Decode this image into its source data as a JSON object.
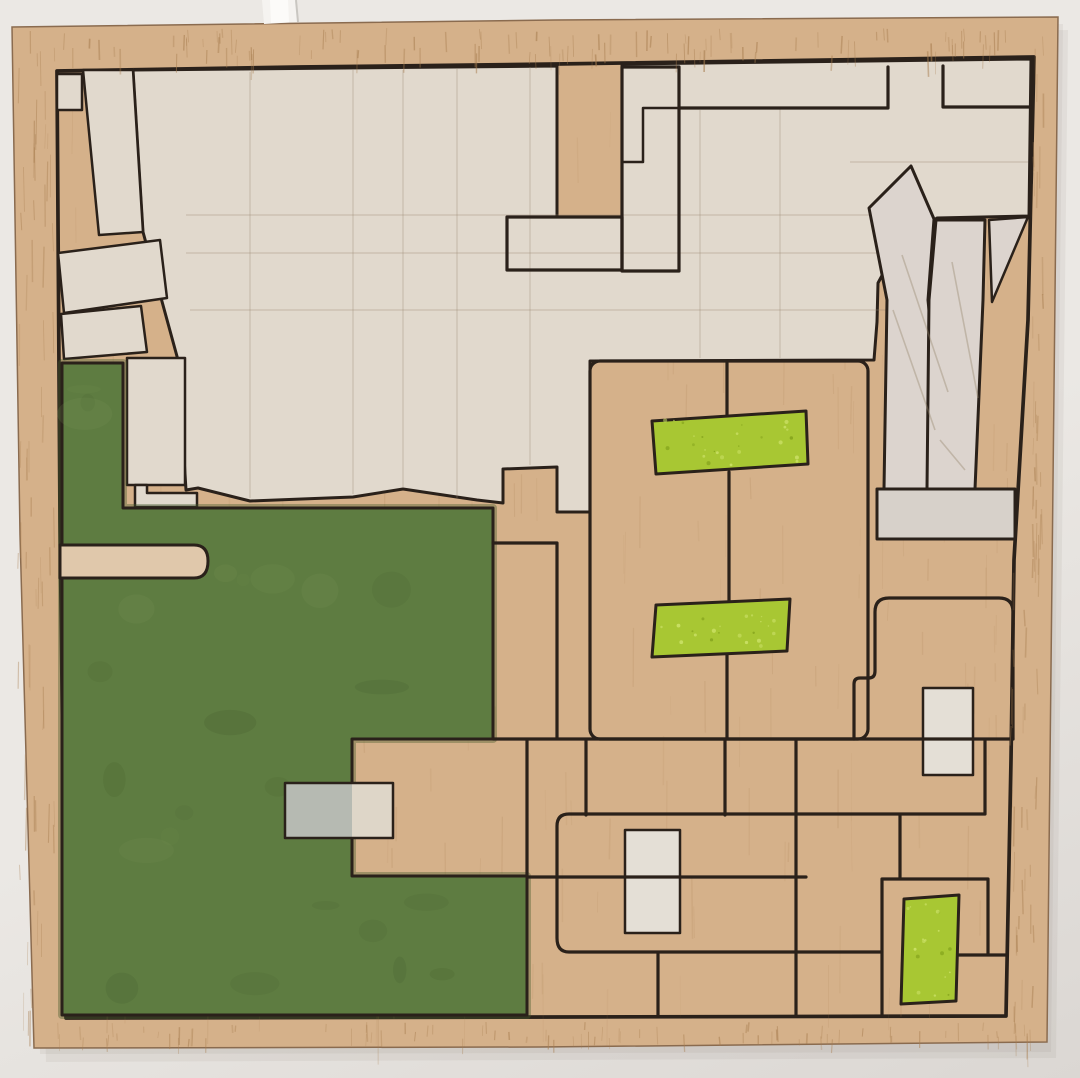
{
  "scene": {
    "type": "photograph of artwork on wall",
    "description": "Square plywood panel hanging on a pale wall; hand-drawn black ink outlines divide the board into irregular rectangular cells; large field painted olive green at lower left, three bright lime-green rectangles, two small whitish blocks, one small grey block, and large cream-painted zones across the top; a white cable hangs at top centre-left.",
    "support": "plywood board with visible wood grain frame margin",
    "hanging_cable": "white cable at top centre-left"
  },
  "elements": {
    "green_field": 1,
    "lime_rectangles": 3,
    "white_blocks": 2,
    "grey_block": 1,
    "cream_zones": 2,
    "x_figure": 1,
    "ink_cells": "irregular hand-drawn rectangular grid"
  },
  "colors": {
    "wall": "#ebe8e4",
    "wallLow": "#dbd7d3",
    "shadow": "#6f675d",
    "cable": "#f5f3f0",
    "cableHi": "#fcfbf9",
    "cableShade": "#c9c6c1",
    "frameWood": "#d5b18a",
    "grainDark": "#a87e50",
    "innerWood": "#e0c8ab",
    "cream": "#e1d9cd",
    "creamBlock": "#ded6c8",
    "paleShape": "#dcd4ce",
    "paleBar": "#d7d1ca",
    "whiteBlock": "#e4dfd6",
    "green": "#5e7c41",
    "greenDark": "#445d2d",
    "greenLight": "#7a9556",
    "lime": "#a8c733",
    "limeSpeck": "#cde26a",
    "limeDark": "#85a41d",
    "gray": "#b6bab2",
    "ink": "#2a211a",
    "pencil": "#97866f"
  },
  "texture": {
    "grain_frame": [
      {
        "x0": 30,
        "x1": 1040,
        "y0": 28,
        "y1": 56,
        "n": 110,
        "l0": 8,
        "l1": 26,
        "o": 0.42
      },
      {
        "x0": 40,
        "x1": 1030,
        "y0": 1022,
        "y1": 1040,
        "n": 80,
        "l0": 6,
        "l1": 18,
        "o": 0.38
      },
      {
        "x0": 18,
        "x1": 54,
        "y0": 34,
        "y1": 1024,
        "n": 60,
        "l0": 14,
        "l1": 46,
        "o": 0.35
      },
      {
        "x0": 1032,
        "x1": 1046,
        "y0": 24,
        "y1": 560,
        "n": 34,
        "l0": 14,
        "l1": 46,
        "o": 0.35
      },
      {
        "x0": 1010,
        "x1": 1038,
        "y0": 560,
        "y1": 1038,
        "n": 34,
        "l0": 12,
        "l1": 40,
        "o": 0.35
      }
    ],
    "grain_inner": [
      {
        "x0": 68,
        "x1": 1020,
        "y0": 64,
        "y1": 1010,
        "n": 260,
        "l0": 18,
        "l1": 70,
        "o": 0.13
      }
    ],
    "green_mottle": [
      {
        "x0": 85,
        "x1": 460,
        "y0": 560,
        "y1": 728,
        "n": 9
      },
      {
        "x0": 85,
        "x1": 330,
        "y0": 772,
        "y1": 995,
        "n": 8
      },
      {
        "x0": 78,
        "x1": 118,
        "y0": 385,
        "y1": 500,
        "n": 3
      },
      {
        "x0": 365,
        "x1": 500,
        "y0": 895,
        "y1": 1000,
        "n": 4
      }
    ],
    "lime_speckles": [
      {
        "x0": 662,
        "x1": 798,
        "y0": 420,
        "y1": 465,
        "n": 26
      },
      {
        "x0": 660,
        "x1": 782,
        "y0": 607,
        "y1": 647,
        "n": 22
      },
      {
        "x0": 907,
        "x1": 951,
        "y0": 901,
        "y1": 996,
        "n": 18
      }
    ]
  }
}
